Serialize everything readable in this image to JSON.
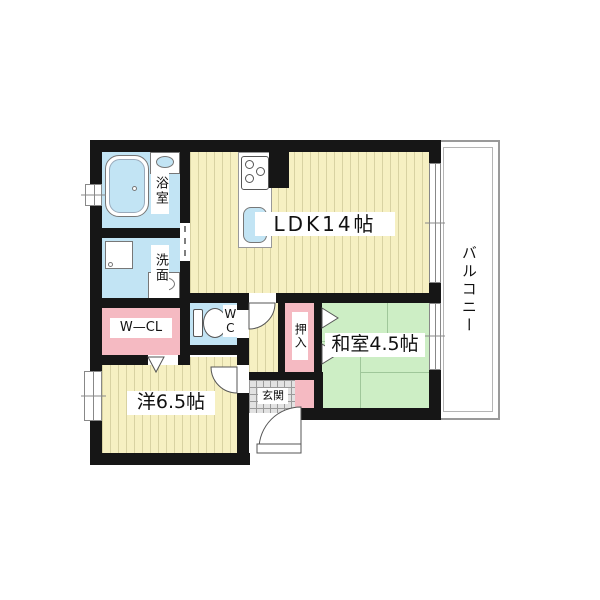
{
  "plan_type": "japanese-apartment-floor-plan",
  "colors": {
    "wall": "#161616",
    "wood_floor": "#f6f0c2",
    "wood_stripe": "#d8d2a2",
    "tatami_green": "#cdeec5",
    "tatami_line": "#9fc79a",
    "closet_pink": "#f5bac2",
    "wet_area_blue": "#c2e4f4",
    "entrance_gray": "#e2e2e2",
    "balcony_line": "#9a9a9a"
  },
  "rooms": {
    "ldk": {
      "label": "LDK14帖"
    },
    "washitsu": {
      "label": "和室4.5帖"
    },
    "youshitsu": {
      "label": "洋6.5帖"
    },
    "bath": {
      "label": "浴室"
    },
    "senmen": {
      "label": "洗面"
    },
    "wcl": {
      "label": "W—CL"
    },
    "wc": {
      "label": "WC"
    },
    "oshiire": {
      "label": "押入"
    },
    "genkan": {
      "label": "玄関"
    },
    "balcony": {
      "label": "バルコニー"
    }
  }
}
